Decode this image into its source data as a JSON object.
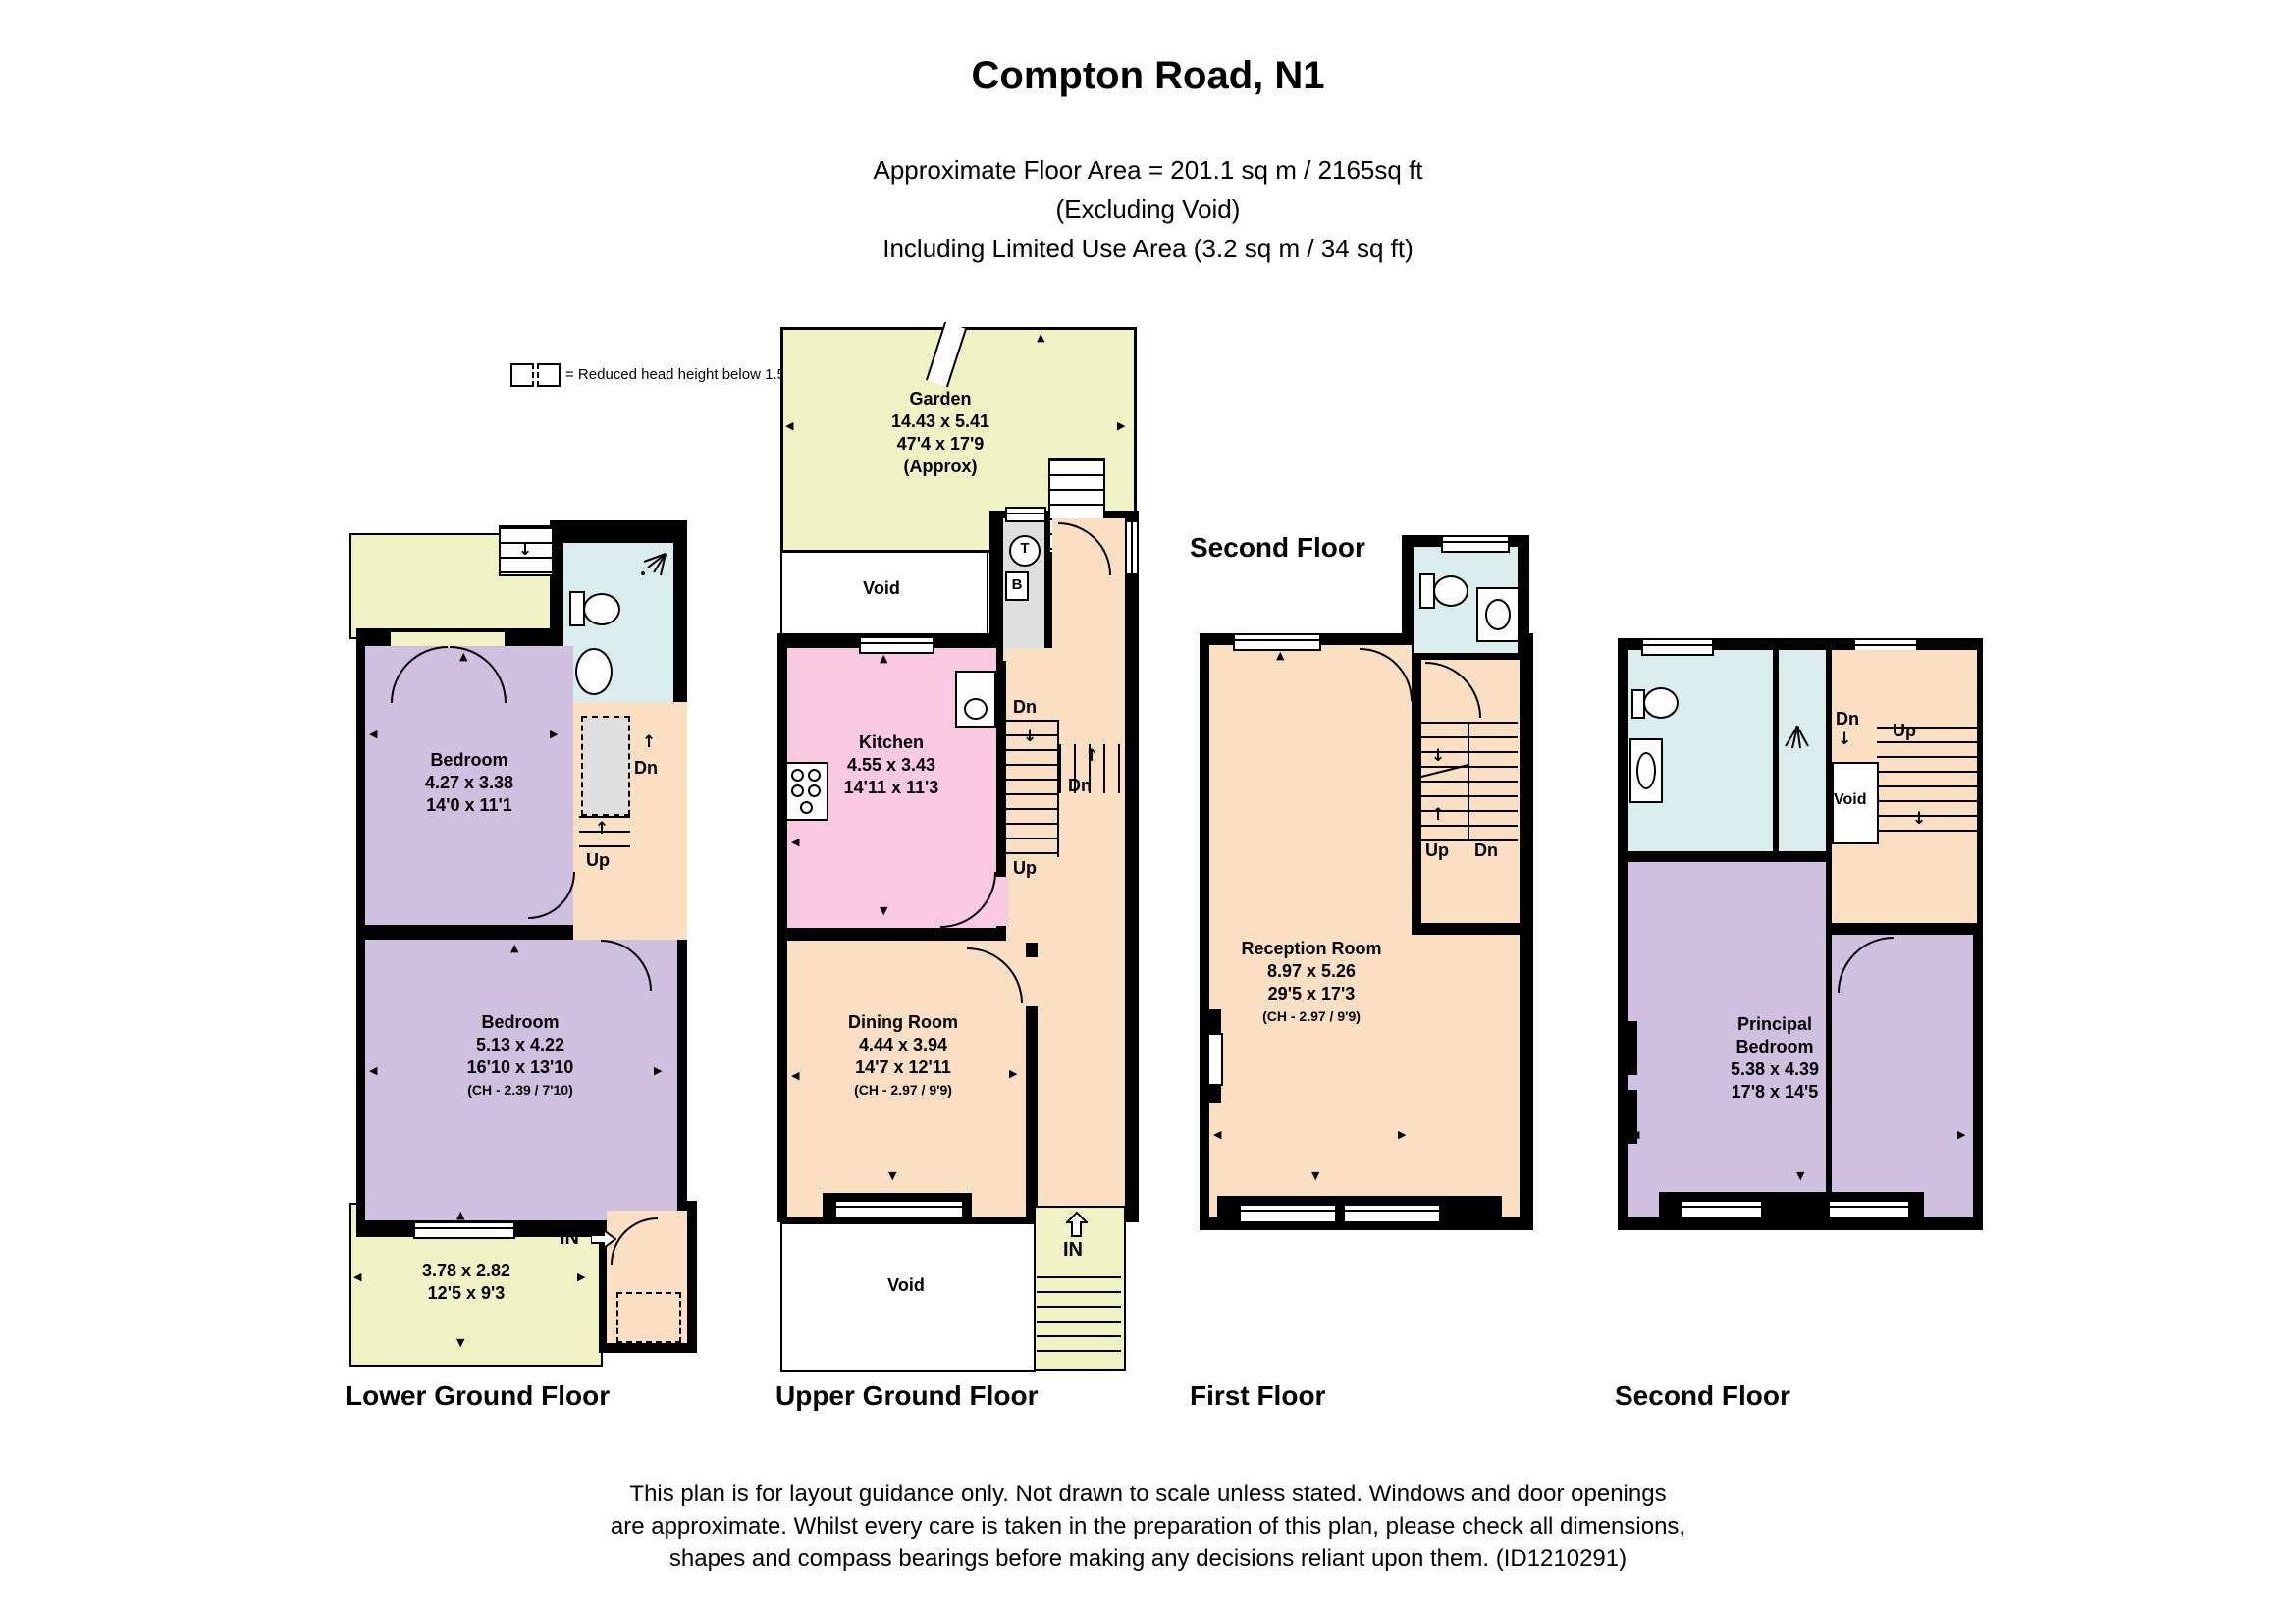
{
  "header": {
    "title": "Compton Road, N1",
    "line1": "Approximate Floor Area = 201.1 sq m / 2165sq ft",
    "line2": "(Excluding Void)",
    "line3": "Including Limited Use Area (3.2 sq m / 34 sq ft)"
  },
  "legend": {
    "text": "= Reduced head height below 1.5m"
  },
  "colors": {
    "wall": "#000000",
    "garden": "#eff3c3",
    "bedroom": "#cfc0e0",
    "bathroom": "#d9edec",
    "kitchen": "#f9c8e1",
    "hall_reception": "#fbdfc3",
    "reduced_head_height": "#dfdfdf"
  },
  "lower_ground": {
    "label": "Lower Ground Floor",
    "bedroom1": {
      "name": "Bedroom",
      "metric": "4.27 x 3.38",
      "imperial": "14'0 x 11'1"
    },
    "bedroom2": {
      "name": "Bedroom",
      "metric": "5.13 x 4.22",
      "imperial": "16'10 x 13'10",
      "ch": "(CH - 2.39 / 7'10)"
    },
    "front": {
      "metric": "3.78 x 2.82",
      "imperial": "12'5 x 9'3"
    },
    "dn": "Dn",
    "up": "Up",
    "in_label": "IN"
  },
  "upper_ground": {
    "label": "Upper Ground Floor",
    "garden": {
      "name": "Garden",
      "metric": "14.43 x 5.41",
      "imperial": "47'4 x 17'9",
      "approx": "(Approx)"
    },
    "void_top": "Void",
    "kitchen": {
      "name": "Kitchen",
      "metric": "4.55 x 3.43",
      "imperial": "14'11 x 11'3"
    },
    "dining": {
      "name": "Dining Room",
      "metric": "4.44 x 3.94",
      "imperial": "14'7 x 12'11",
      "ch": "(CH - 2.97 / 9'9)"
    },
    "void_bottom": "Void",
    "tank": "T",
    "boiler": "B",
    "dn1": "Dn",
    "dn2": "Dn",
    "up": "Up",
    "in_label": "IN"
  },
  "first_floor": {
    "label": "First Floor",
    "note": "Second Floor",
    "reception": {
      "name": "Reception Room",
      "metric": "8.97 x 5.26",
      "imperial": "29'5 x 17'3",
      "ch": "(CH - 2.97 / 9'9)"
    },
    "up": "Up",
    "dn": "Dn"
  },
  "second_floor": {
    "label": "Second Floor",
    "principal": {
      "name_line1": "Principal",
      "name_line2": "Bedroom",
      "metric": "5.38 x 4.39",
      "imperial": "17'8 x 14'5"
    },
    "void": "Void",
    "dn": "Dn",
    "up": "Up"
  },
  "footer": {
    "line1": "This plan is for layout guidance only. Not drawn to scale unless stated. Windows and door openings",
    "line2": "are approximate. Whilst every care is taken in the preparation of this plan, please check all dimensions,",
    "line3": "shapes and compass bearings before making any decisions reliant upon them. (ID1210291)"
  }
}
